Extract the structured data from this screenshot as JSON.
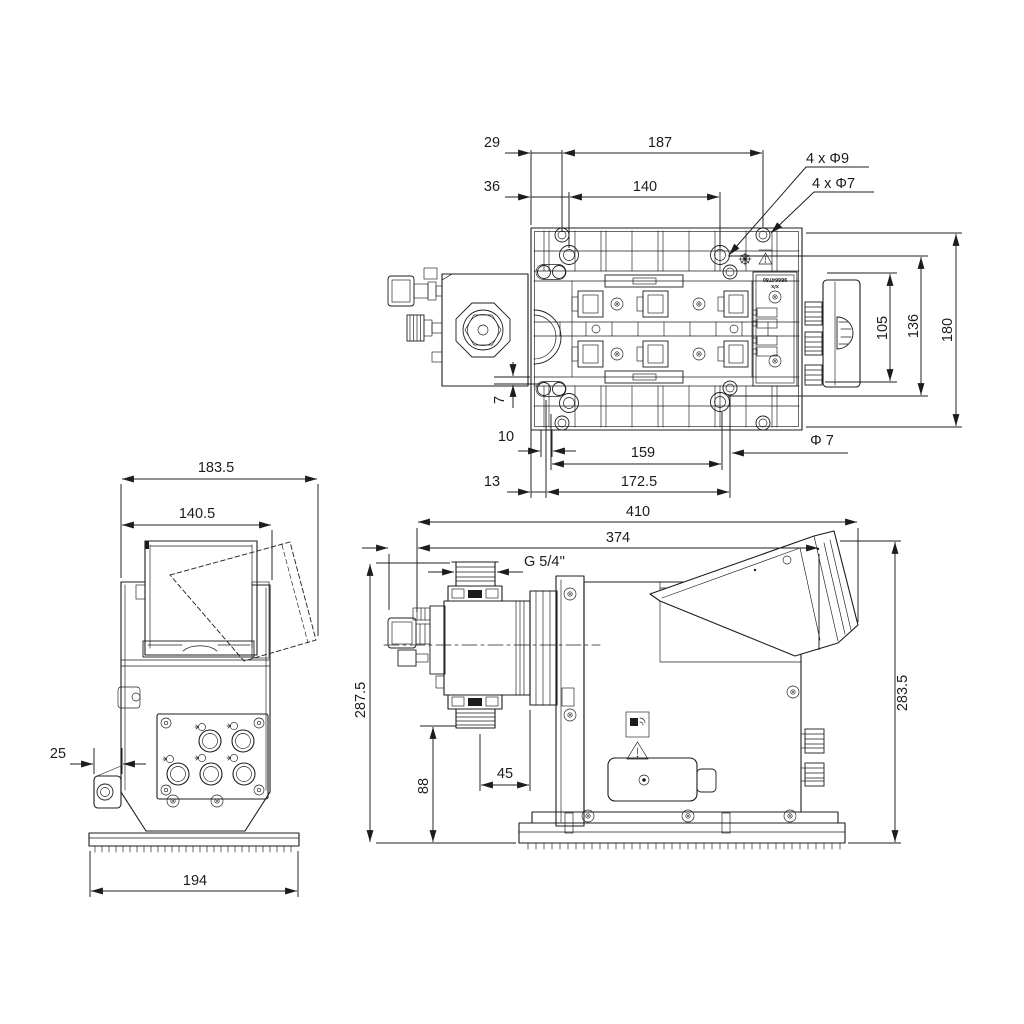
{
  "drawing_type": "engineering-dimension-drawing",
  "colors": {
    "line": "#1c1c1c",
    "background": "#ffffff"
  },
  "top_view": {
    "d29": "29",
    "d187": "187",
    "d36": "36",
    "d140": "140",
    "holes9": "4 x Φ9",
    "holes7": "4 x Φ7",
    "d105": "105",
    "d136": "136",
    "d180": "180",
    "d7": "7",
    "d10": "10",
    "d159": "159",
    "dia7": "Φ 7",
    "d13": "13",
    "d172_5": "172.5",
    "nameplate_line1": "x/x",
    "nameplate_line2": "98664780"
  },
  "front_view": {
    "d183_5": "183.5",
    "d140_5": "140.5",
    "d25": "25",
    "d194": "194"
  },
  "side_view": {
    "d410": "410",
    "d374": "374",
    "thread": "G 5/4''",
    "d287_5": "287.5",
    "d283_5": "283.5",
    "d88": "88",
    "d45": "45"
  }
}
